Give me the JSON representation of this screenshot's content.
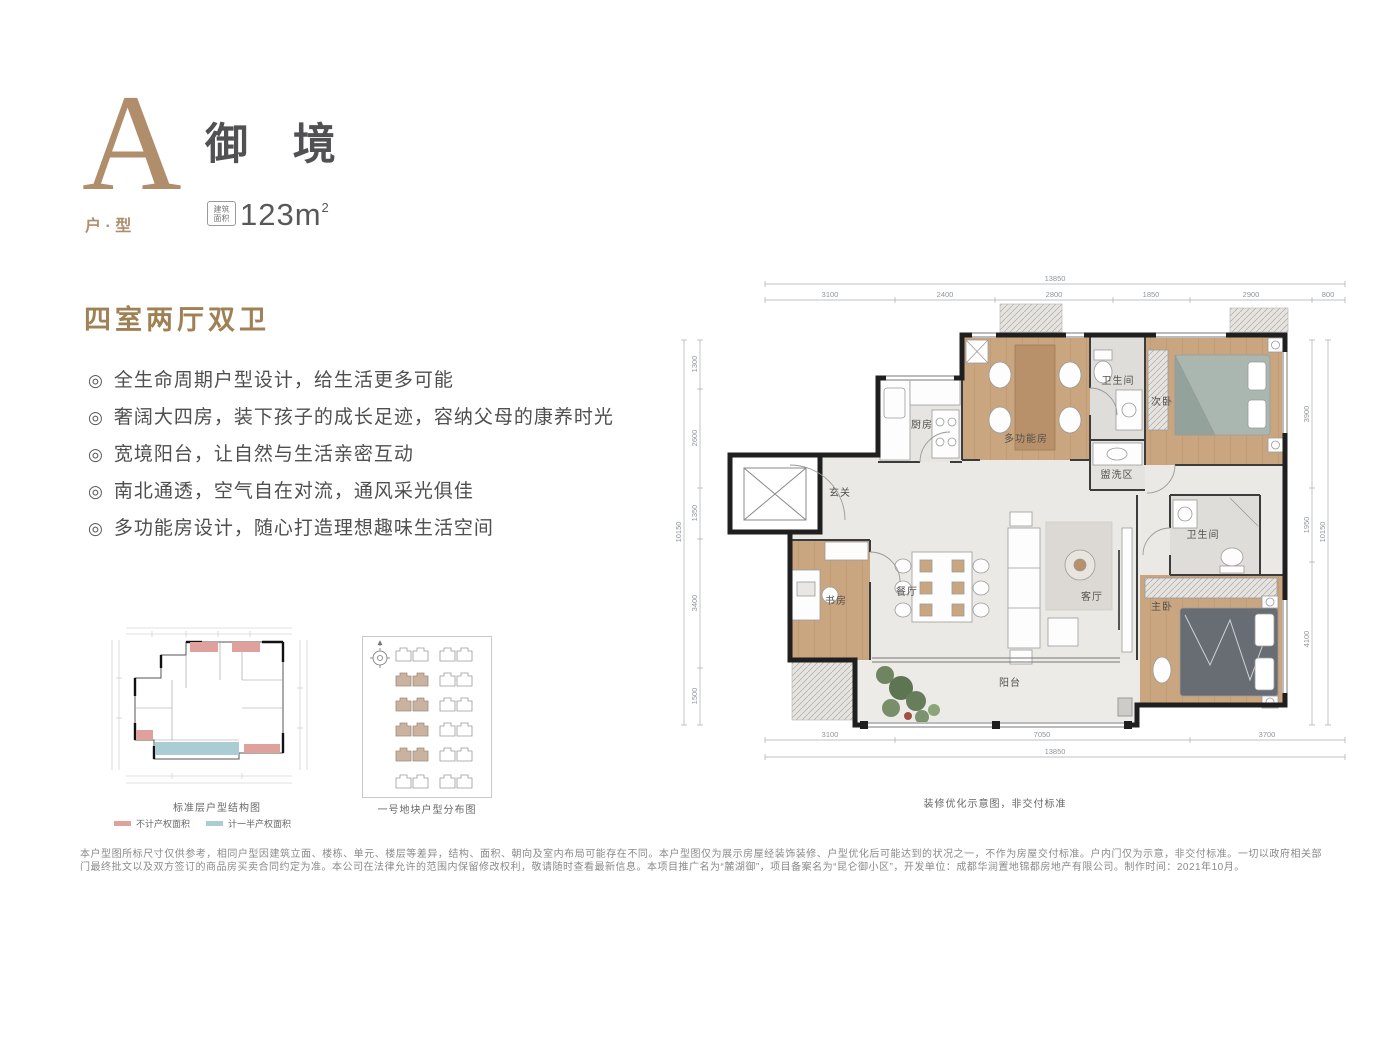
{
  "colors": {
    "accent_tan": "#b08e6b",
    "heading_brown": "#a08155",
    "title_gray": "#515153",
    "wall_black": "#1f1f1f",
    "wood_floor": "#c9a67f",
    "legend_pink": "#dfa19b",
    "legend_teal": "#a9cdd2",
    "site_building_fill": "#c9b2a0"
  },
  "header": {
    "type_letter": "A",
    "type_label": "户 · 型",
    "title": "御 境",
    "area_badge_line1": "建筑",
    "area_badge_line2": "面积",
    "area_value": "123m",
    "area_sup": "2"
  },
  "features": {
    "heading": "四室两厅双卫",
    "bullet": "◎",
    "items": [
      "全生命周期户型设计，给生活更多可能",
      "奢阔大四房，装下孩子的成长足迹，容纳父母的康养时光",
      "宽境阳台，让自然与生活亲密互动",
      "南北通透，空气自在对流，通风采光俱佳",
      "多功能房设计，随心打造理想趣味生活空间"
    ]
  },
  "mini_plan": {
    "caption": "标准层户型结构图",
    "legend": [
      {
        "label": "不计产权面积",
        "color": "#dfa19b"
      },
      {
        "label": "计一半产权面积",
        "color": "#a9cdd2"
      }
    ]
  },
  "site_plan": {
    "caption": "一号地块户型分布图"
  },
  "floor_plan": {
    "caption": "装修优化示意图，非交付标准",
    "rooms": {
      "entry": "玄关",
      "kitchen": "厨房",
      "multi": "多功能房",
      "bath1": "卫生间",
      "wash": "盥洗区",
      "bed2": "次卧",
      "study": "书房",
      "dining": "餐厅",
      "living": "客厅",
      "bath2": "卫生间",
      "master": "主卧",
      "balcony": "阳台"
    },
    "dims": {
      "top_total": "13850",
      "top": [
        "3100",
        "2400",
        "2800",
        "1850",
        "2900",
        "800"
      ],
      "bottom_total": "13850",
      "bottom": [
        "3100",
        "7050",
        "3700"
      ],
      "left_total": "10150",
      "left": [
        "1300",
        "2600",
        "1350",
        "3400",
        "1500"
      ],
      "right_total": "10150",
      "right": [
        "3900",
        "1950",
        "4100"
      ]
    }
  },
  "disclaimer": {
    "text": "本户型图所标尺寸仅供参考，相同户型因建筑立面、楼栋、单元、楼层等差异，结构、面积、朝向及室内布局可能存在不同。本户型图仅为展示房屋经装饰装修、户型优化后可能达到的状况之一，不作为房屋交付标准。户内门仅为示意，非交付标准。一切以政府相关部门最终批文以及双方签订的商品房买卖合同约定为准。本公司在法律允许的范围内保留修改权利，敬请随时查看最新信息。本项目推广名为“麓湖御”，项目备案名为“昆仑御小区”，开发单位：成都华润置地锦都房地产有限公司。制作时间：2021年10月。"
  }
}
